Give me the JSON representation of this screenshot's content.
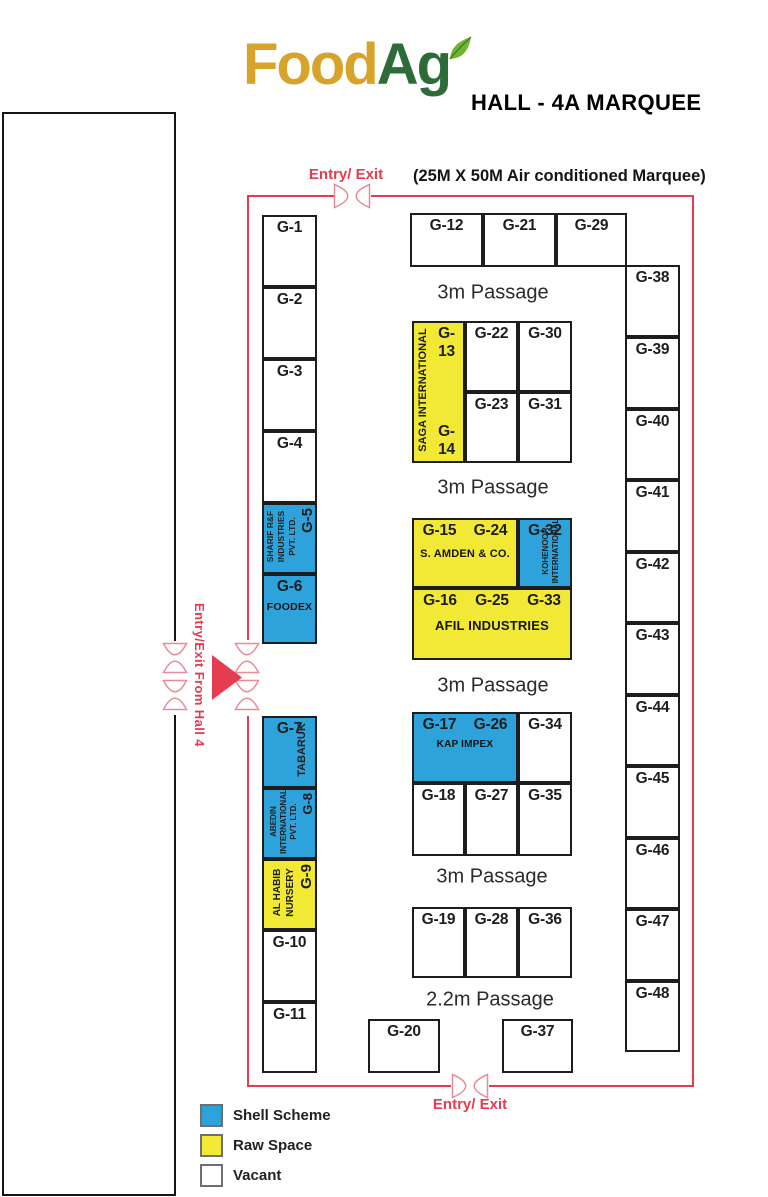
{
  "header": {
    "logo_food": "Food",
    "logo_ag": "Ag",
    "hall_title": "HALL - 4A MARQUEE",
    "marquee_note": "(25M X 50M Air conditioned Marquee)"
  },
  "entries": {
    "top_label": "Entry/ Exit",
    "bottom_label": "Entry/ Exit",
    "hall4_label": "Entry/Exit From Hall 4"
  },
  "passages": [
    {
      "label": "3m Passage",
      "x": 493,
      "y": 293
    },
    {
      "label": "3m Passage",
      "x": 493,
      "y": 488
    },
    {
      "label": "3m Passage",
      "x": 493,
      "y": 686
    },
    {
      "label": "3m Passage",
      "x": 492,
      "y": 877
    },
    {
      "label": "2.2m Passage",
      "x": 490,
      "y": 1000
    }
  ],
  "legend": {
    "items": [
      {
        "label": "Shell Scheme",
        "type": "shell"
      },
      {
        "label": "Raw Space",
        "type": "raw"
      },
      {
        "label": "Vacant",
        "type": "vacant"
      }
    ]
  },
  "colors": {
    "shell": "#2EA3DB",
    "raw": "#F2E937",
    "vacant": "#FFFFFF",
    "red": "#E63C50",
    "icon_stroke": "#E78D99",
    "logo_food": "#D7A32B",
    "logo_ag": "#2D6B38",
    "leaf": "#6FB52F"
  },
  "booths": [
    {
      "id": "G-1",
      "x": 262,
      "y": 215,
      "w": 55,
      "h": 72,
      "type": "vacant",
      "label": "G-1"
    },
    {
      "id": "G-2",
      "x": 262,
      "y": 287,
      "w": 55,
      "h": 72,
      "type": "vacant",
      "label": "G-2"
    },
    {
      "id": "G-3",
      "x": 262,
      "y": 359,
      "w": 55,
      "h": 72,
      "type": "vacant",
      "label": "G-3"
    },
    {
      "id": "G-4",
      "x": 262,
      "y": 431,
      "w": 55,
      "h": 72,
      "type": "vacant",
      "label": "G-4"
    },
    {
      "id": "G-5",
      "x": 262,
      "y": 503,
      "w": 55,
      "h": 71,
      "type": "shell",
      "company_name": "SHARIF R&F INDUSTRIES PVT. LTD.",
      "v": {
        "align": "right",
        "pad": 1,
        "cols": [
          {
            "t": "SHARIF R&F",
            "s": 8.5,
            "lh": 11
          },
          {
            "t": "INDUSTRIES",
            "s": 8.5,
            "lh": 11
          },
          {
            "t": "PVT. LTD.",
            "s": 8.5,
            "lh": 11
          },
          {
            "t": "G-5",
            "s": 15,
            "lh": 20,
            "ta": "right"
          }
        ]
      }
    },
    {
      "id": "G-6",
      "x": 262,
      "y": 574,
      "w": 55,
      "h": 70,
      "type": "shell",
      "label": "G-6",
      "company": "FOODEX",
      "companySize": 10.5,
      "companyMt": 5
    },
    {
      "id": "G-7",
      "x": 262,
      "y": 716,
      "w": 55,
      "h": 72,
      "type": "shell",
      "label": "G-7",
      "company_name": "TABARUK",
      "v": {
        "align": "right",
        "pad": 9,
        "cols": [
          {
            "t": "TABARUK",
            "s": 11,
            "lh": 15
          }
        ]
      }
    },
    {
      "id": "G-8",
      "x": 262,
      "y": 788,
      "w": 55,
      "h": 71,
      "type": "shell",
      "company_name": "ABEDIN INTERNATIONAL PVT. LTD.",
      "v": {
        "align": "right",
        "pad": 3,
        "cols": [
          {
            "t": "ABEDIN",
            "s": 8,
            "lh": 10
          },
          {
            "t": "INTERNATIONAL",
            "s": 8,
            "lh": 10
          },
          {
            "t": "PVT. LTD.",
            "s": 8,
            "lh": 10
          },
          {
            "t": "G-8",
            "s": 13,
            "lh": 17,
            "ta": "right"
          }
        ]
      }
    },
    {
      "id": "G-9",
      "x": 262,
      "y": 859,
      "w": 55,
      "h": 71,
      "type": "raw",
      "company_name": "AL HABIB NURSERY",
      "v": {
        "align": "right",
        "pad": 3,
        "cols": [
          {
            "t": "AL HABIB",
            "s": 10,
            "lh": 13
          },
          {
            "t": "NURSERY",
            "s": 10,
            "lh": 13
          },
          {
            "t": "G-9",
            "s": 15,
            "lh": 19,
            "ta": "right"
          }
        ]
      }
    },
    {
      "id": "G-10",
      "x": 262,
      "y": 930,
      "w": 55,
      "h": 72,
      "type": "vacant",
      "label": "G-10"
    },
    {
      "id": "G-11",
      "x": 262,
      "y": 1002,
      "w": 55,
      "h": 71,
      "type": "vacant",
      "label": "G-11"
    },
    {
      "id": "G-12",
      "x": 410,
      "y": 213,
      "w": 73,
      "h": 54,
      "type": "vacant",
      "label": "G-12"
    },
    {
      "id": "G-21",
      "x": 483,
      "y": 213,
      "w": 73,
      "h": 54,
      "type": "vacant",
      "label": "G-21"
    },
    {
      "id": "G-29",
      "x": 556,
      "y": 213,
      "w": 71,
      "h": 54,
      "type": "vacant",
      "label": "G-29"
    },
    {
      "id": "G-13-G-14",
      "x": 412,
      "y": 321,
      "w": 53,
      "h": 142,
      "type": "raw",
      "label": "G-13",
      "label2": "G-14",
      "labelIndent": 16,
      "company_name": "SAGA INTERNATIONAL",
      "v": {
        "align": "left",
        "pad": 2,
        "cols": [
          {
            "t": "SAGA INTERNATIONAL",
            "s": 11,
            "lh": 15
          }
        ]
      }
    },
    {
      "id": "G-22",
      "x": 465,
      "y": 321,
      "w": 53,
      "h": 71,
      "type": "vacant",
      "label": "G-22"
    },
    {
      "id": "G-30",
      "x": 518,
      "y": 321,
      "w": 54,
      "h": 71,
      "type": "vacant",
      "label": "G-30"
    },
    {
      "id": "G-23",
      "x": 465,
      "y": 392,
      "w": 53,
      "h": 71,
      "type": "vacant",
      "label": "G-23"
    },
    {
      "id": "G-31",
      "x": 518,
      "y": 392,
      "w": 54,
      "h": 71,
      "type": "vacant",
      "label": "G-31"
    },
    {
      "id": "G-15-G-24",
      "x": 412,
      "y": 518,
      "w": 106,
      "h": 70,
      "type": "raw",
      "labels": [
        "G-15",
        "G-24"
      ],
      "company": "S. AMDEN & CO.",
      "companySize": 11,
      "companyMt": 8
    },
    {
      "id": "G-32",
      "x": 518,
      "y": 518,
      "w": 54,
      "h": 70,
      "type": "shell",
      "label": "G-32",
      "company_name": "KOHENOOR INTERNATIONAL",
      "v": {
        "align": "center",
        "pad": 4,
        "cols": [
          {
            "t": "KOHENOOR",
            "s": 8,
            "lh": 10
          },
          {
            "t": "INTERNATIONAL",
            "s": 8,
            "lh": 10
          }
        ]
      }
    },
    {
      "id": "G-16-G-25-G-33",
      "x": 412,
      "y": 588,
      "w": 160,
      "h": 72,
      "type": "raw",
      "labels": [
        "G-16",
        "G-25",
        "G-33"
      ],
      "company": "AFIL INDUSTRIES",
      "companySize": 13,
      "companyMt": 8
    },
    {
      "id": "G-17-G-26",
      "x": 412,
      "y": 712,
      "w": 106,
      "h": 71,
      "type": "shell",
      "labels": [
        "G-17",
        "G-26"
      ],
      "company": "KAP IMPEX",
      "companySize": 10,
      "companyMt": 5
    },
    {
      "id": "G-34",
      "x": 518,
      "y": 712,
      "w": 54,
      "h": 71,
      "type": "vacant",
      "label": "G-34"
    },
    {
      "id": "G-18",
      "x": 412,
      "y": 783,
      "w": 53,
      "h": 73,
      "type": "vacant",
      "label": "G-18"
    },
    {
      "id": "G-27",
      "x": 465,
      "y": 783,
      "w": 53,
      "h": 73,
      "type": "vacant",
      "label": "G-27"
    },
    {
      "id": "G-35",
      "x": 518,
      "y": 783,
      "w": 54,
      "h": 73,
      "type": "vacant",
      "label": "G-35"
    },
    {
      "id": "G-19",
      "x": 412,
      "y": 907,
      "w": 53,
      "h": 71,
      "type": "vacant",
      "label": "G-19"
    },
    {
      "id": "G-28",
      "x": 465,
      "y": 907,
      "w": 53,
      "h": 71,
      "type": "vacant",
      "label": "G-28"
    },
    {
      "id": "G-36",
      "x": 518,
      "y": 907,
      "w": 54,
      "h": 71,
      "type": "vacant",
      "label": "G-36"
    },
    {
      "id": "G-20",
      "x": 368,
      "y": 1019,
      "w": 72,
      "h": 54,
      "type": "vacant",
      "label": "G-20"
    },
    {
      "id": "G-37",
      "x": 502,
      "y": 1019,
      "w": 71,
      "h": 54,
      "type": "vacant",
      "label": "G-37"
    },
    {
      "id": "G-38",
      "x": 625,
      "y": 265,
      "w": 55,
      "h": 72,
      "type": "vacant",
      "label": "G-38"
    },
    {
      "id": "G-39",
      "x": 625,
      "y": 337,
      "w": 55,
      "h": 72,
      "type": "vacant",
      "label": "G-39"
    },
    {
      "id": "G-40",
      "x": 625,
      "y": 409,
      "w": 55,
      "h": 71,
      "type": "vacant",
      "label": "G-40"
    },
    {
      "id": "G-41",
      "x": 625,
      "y": 480,
      "w": 55,
      "h": 72,
      "type": "vacant",
      "label": "G-41"
    },
    {
      "id": "G-42",
      "x": 625,
      "y": 552,
      "w": 55,
      "h": 71,
      "type": "vacant",
      "label": "G-42"
    },
    {
      "id": "G-43",
      "x": 625,
      "y": 623,
      "w": 55,
      "h": 72,
      "type": "vacant",
      "label": "G-43"
    },
    {
      "id": "G-44",
      "x": 625,
      "y": 695,
      "w": 55,
      "h": 71,
      "type": "vacant",
      "label": "G-44"
    },
    {
      "id": "G-45",
      "x": 625,
      "y": 766,
      "w": 55,
      "h": 72,
      "type": "vacant",
      "label": "G-45"
    },
    {
      "id": "G-46",
      "x": 625,
      "y": 838,
      "w": 55,
      "h": 71,
      "type": "vacant",
      "label": "G-46"
    },
    {
      "id": "G-47",
      "x": 625,
      "y": 909,
      "w": 55,
      "h": 72,
      "type": "vacant",
      "label": "G-47"
    },
    {
      "id": "G-48",
      "x": 625,
      "y": 981,
      "w": 55,
      "h": 71,
      "type": "vacant",
      "label": "G-48"
    }
  ]
}
